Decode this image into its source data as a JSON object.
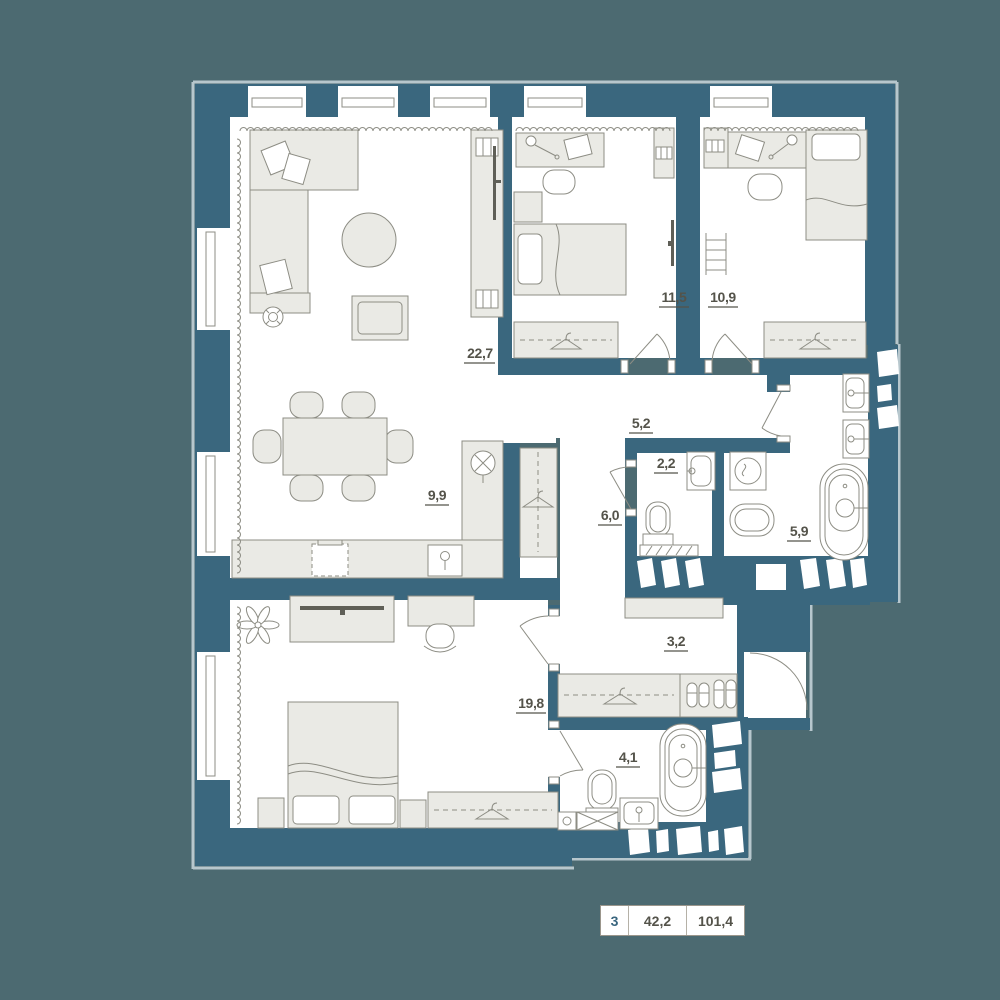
{
  "plan": {
    "rooms": [
      {
        "name": "living-room",
        "area": "22,7"
      },
      {
        "name": "kitchen-dining",
        "area": "9,9"
      },
      {
        "name": "bedroom-1",
        "area": "11,5"
      },
      {
        "name": "bedroom-2",
        "area": "10,9"
      },
      {
        "name": "hallway",
        "area": "5,2"
      },
      {
        "name": "wc",
        "area": "2,2"
      },
      {
        "name": "hall",
        "area": "6,0"
      },
      {
        "name": "bathroom",
        "area": "5,9"
      },
      {
        "name": "corridor",
        "area": "3,2"
      },
      {
        "name": "master-bedroom",
        "area": "19,8"
      },
      {
        "name": "ensuite-bathroom",
        "area": "4,1"
      }
    ],
    "legend": {
      "rooms_count": "3",
      "living_area": "42,2",
      "total_area": "101,4"
    },
    "colors": {
      "wall": "#3A677E",
      "background": "#4C6A71",
      "facade": "#B7C7CD",
      "furniture": "#EAEAE5",
      "furniture_stroke": "#8D8D84",
      "label": "#54534A",
      "accent": "#39657E"
    }
  }
}
